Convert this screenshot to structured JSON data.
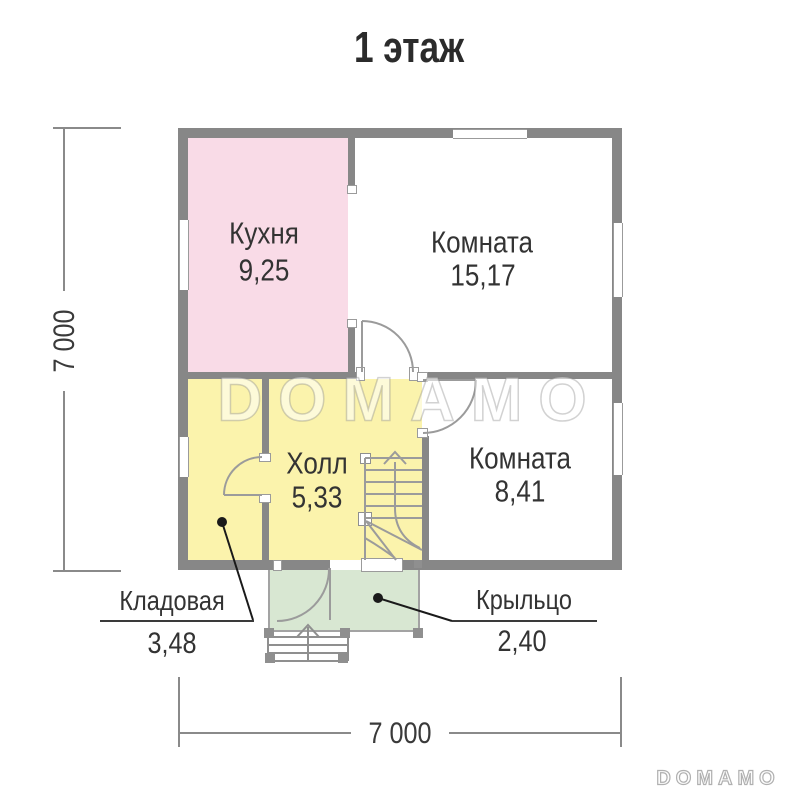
{
  "title": "1 этаж",
  "watermark": "DOMAMO",
  "brand_logo": "DOMAMO",
  "rooms": [
    {
      "name": "Кухня",
      "area": "9,25"
    },
    {
      "name": "Комната",
      "area": "15,17"
    },
    {
      "name": "Холл",
      "area": "5,33"
    },
    {
      "name": "Комната",
      "area": "8,41"
    },
    {
      "name": "Кладовая",
      "area": "3,48"
    },
    {
      "name": "Крыльцо",
      "area": "2,40"
    }
  ],
  "dimensions": {
    "vertical": "7 000",
    "horizontal": "7 000"
  },
  "colors": {
    "wall": "#878787",
    "kitchen_fill": "#f9dbe7",
    "hall_fill": "#fbf3ac",
    "porch_fill": "#d8e7d2",
    "line": "#9b9b9b",
    "label_text": "#333333"
  }
}
